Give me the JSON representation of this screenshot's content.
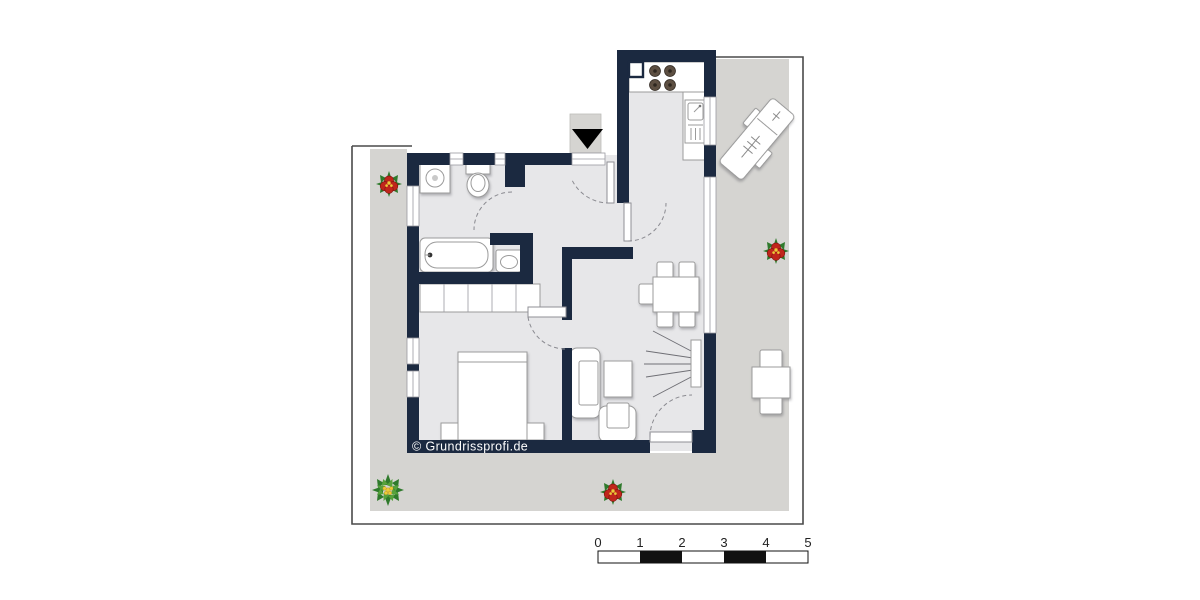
{
  "copyright": {
    "text": "© Grundrissprofi.de"
  },
  "scale_bar": {
    "labels": [
      "0",
      "1",
      "2",
      "3",
      "4",
      "5"
    ],
    "segments": [
      "white",
      "black",
      "white",
      "black",
      "white"
    ]
  },
  "colors": {
    "wall": "#1b2940",
    "floor": "#e7e7e9",
    "terrace": "#d5d4d1",
    "outline": "#4a4a4a",
    "stroke": "#9b9b9b",
    "scalebar": "#111111",
    "burner": "#5d4f42",
    "arrow": "#000000",
    "flower_red": "#c0261c",
    "flower_green": "#2f7a2c",
    "flower_green_light": "#57a23c",
    "flower_yellow": "#eccb3a"
  },
  "furniture_icons": [
    "entrance-arrow-icon",
    "washing-machine-icon",
    "toilet-icon",
    "bathtub-icon",
    "washbasin-icon",
    "wardrobe-icon",
    "double-bed-icon",
    "nightstand-icon",
    "sofa-icon",
    "coffee-table-icon",
    "armchair-icon",
    "tv-icon",
    "dining-table-icon",
    "dining-chair-icon",
    "stove-icon",
    "kitchen-sink-icon",
    "kitchen-duct-icon",
    "sun-lounger-icon",
    "terrace-table-icon",
    "terrace-chair-icon",
    "flower-pot-icon",
    "door-swing-arc",
    "window-icon"
  ]
}
